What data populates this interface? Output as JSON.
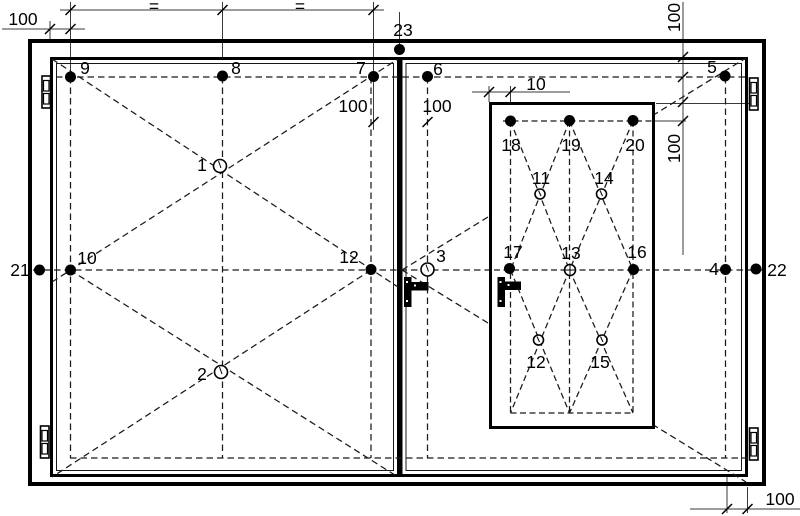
{
  "drawing": {
    "width": 800,
    "height": 516
  },
  "colors": {
    "line": "#000000",
    "thin_line": "#3a3a3a",
    "dashed_line": "#1a1a1a",
    "background": "#ffffff"
  },
  "points": [
    {
      "label": "1",
      "type": "open",
      "x": 220,
      "y": 166,
      "r": 6.5,
      "lx": 202,
      "ly": 171
    },
    {
      "label": "2",
      "type": "open",
      "x": 221,
      "y": 372,
      "r": 6.5,
      "lx": 202,
      "ly": 380
    },
    {
      "label": "3",
      "type": "open",
      "x": 427.5,
      "y": 269.5,
      "r": 6.5,
      "lx": 441,
      "ly": 262
    },
    {
      "label": "4",
      "type": "filled",
      "x": 725.5,
      "y": 269.5,
      "r": 5.5,
      "lx": 714,
      "ly": 275
    },
    {
      "label": "5",
      "type": "filled",
      "x": 725,
      "y": 76,
      "r": 5.5,
      "lx": 712,
      "ly": 73
    },
    {
      "label": "6",
      "type": "filled",
      "x": 427.5,
      "y": 76.5,
      "r": 5.5,
      "lx": 438,
      "ly": 75
    },
    {
      "label": "7",
      "type": "filled",
      "x": 373.5,
      "y": 76.5,
      "r": 5.5,
      "lx": 361,
      "ly": 74
    },
    {
      "label": "8",
      "type": "filled",
      "x": 222.5,
      "y": 76,
      "r": 5.5,
      "lx": 236,
      "ly": 74
    },
    {
      "label": "9",
      "type": "filled",
      "x": 70.5,
      "y": 77,
      "r": 5.5,
      "lx": 85,
      "ly": 74
    },
    {
      "label": "10",
      "type": "filled",
      "x": 70.5,
      "y": 270,
      "r": 5.5,
      "lx": 87,
      "ly": 264
    },
    {
      "label": "11",
      "type": "open",
      "x": 540,
      "y": 194,
      "r": 5,
      "lx": 541,
      "ly": 184
    },
    {
      "label": "12",
      "type": "filled",
      "x": 371,
      "y": 269.5,
      "r": 5.5,
      "lx": 349,
      "ly": 263
    },
    {
      "label": "12",
      "type": "open",
      "x": 538.5,
      "y": 340,
      "r": 5,
      "lx": 536,
      "ly": 368
    },
    {
      "label": "13",
      "type": "open-cross",
      "x": 570,
      "y": 270,
      "r": 5.5,
      "lx": 571,
      "ly": 259
    },
    {
      "label": "14",
      "type": "open",
      "x": 601.5,
      "y": 194,
      "r": 5,
      "lx": 604,
      "ly": 184
    },
    {
      "label": "15",
      "type": "open",
      "x": 602,
      "y": 340,
      "r": 5,
      "lx": 600,
      "ly": 368
    },
    {
      "label": "16",
      "type": "filled",
      "x": 633.5,
      "y": 269.5,
      "r": 5.5,
      "lx": 637,
      "ly": 258
    },
    {
      "label": "17",
      "type": "filled",
      "x": 509.5,
      "y": 268.5,
      "r": 5.5,
      "lx": 513,
      "ly": 258
    },
    {
      "label": "18",
      "type": "filled",
      "x": 510.5,
      "y": 121,
      "r": 5.5,
      "lx": 511,
      "ly": 151
    },
    {
      "label": "19",
      "type": "filled",
      "x": 569.5,
      "y": 120.5,
      "r": 5.5,
      "lx": 571,
      "ly": 151
    },
    {
      "label": "20",
      "type": "filled",
      "x": 633,
      "y": 120.5,
      "r": 5.5,
      "lx": 635,
      "ly": 151
    },
    {
      "label": "21",
      "type": "filled",
      "x": 39.5,
      "y": 270,
      "r": 5.5,
      "lx": 20,
      "ly": 276
    },
    {
      "label": "22",
      "type": "filled",
      "x": 756,
      "y": 269,
      "r": 5.5,
      "lx": 777,
      "ly": 276
    },
    {
      "label": "23",
      "type": "filled",
      "x": 399.5,
      "y": 49.5,
      "r": 5.5,
      "lx": 403,
      "ly": 36
    }
  ],
  "dimensions": [
    {
      "label": "100",
      "x": 23,
      "y": 25,
      "rot": 0
    },
    {
      "label": "=",
      "x": 154,
      "y": 12,
      "rot": 0
    },
    {
      "label": "=",
      "x": 300,
      "y": 12,
      "rot": 0
    },
    {
      "label": "100",
      "x": 353,
      "y": 112,
      "rot": 0
    },
    {
      "label": "100",
      "x": 437,
      "y": 112,
      "rot": 0
    },
    {
      "label": "10",
      "x": 536,
      "y": 90,
      "rot": 0
    },
    {
      "label": "100",
      "x": 680,
      "y": 17.5,
      "rot": -90
    },
    {
      "label": "100",
      "x": 680,
      "y": 148.5,
      "rot": -90
    },
    {
      "label": "100",
      "x": 780,
      "y": 505,
      "rot": 0
    }
  ]
}
